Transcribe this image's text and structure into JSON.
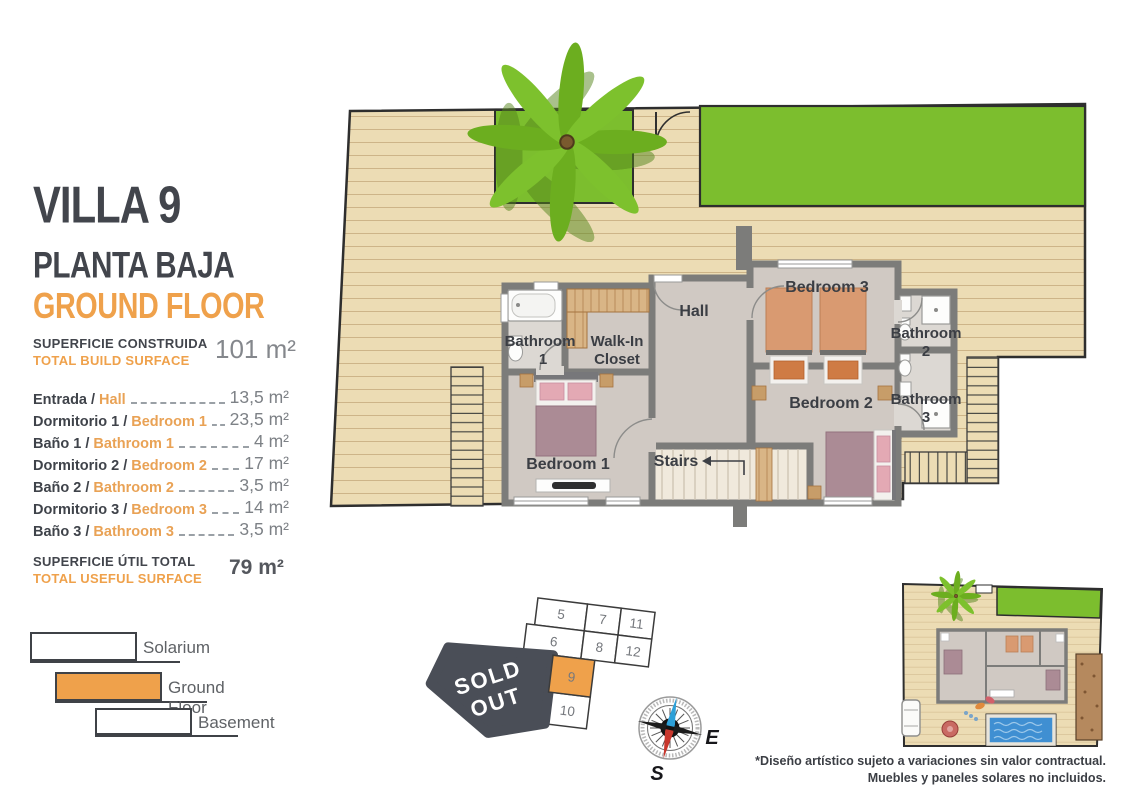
{
  "panel": {
    "title": "VILLA 9",
    "subtitle_es": "PLANTA BAJA",
    "subtitle_en": "GROUND FLOOR",
    "build": {
      "label_es": "SUPERFICIE CONSTRUIDA",
      "label_en": "TOTAL BUILD SURFACE",
      "value": "101 m²"
    },
    "rooms": [
      {
        "es": "Entrada /",
        "en": "Hall",
        "value": "13,5 m²"
      },
      {
        "es": "Dormitorio 1 /",
        "en": "Bedroom 1",
        "value": "23,5 m²"
      },
      {
        "es": "Baño 1 /",
        "en": "Bathroom 1",
        "value": "4 m²"
      },
      {
        "es": "Dormitorio 2 /",
        "en": "Bedroom 2",
        "value": "17 m²"
      },
      {
        "es": "Baño 2 /",
        "en": "Bathroom 2",
        "value": "3,5 m²"
      },
      {
        "es": "Dormitorio 3 /",
        "en": "Bedroom 3",
        "value": "14 m²"
      },
      {
        "es": "Baño 3 /",
        "en": "Bathroom 3",
        "value": "3,5 m²"
      }
    ],
    "useful": {
      "label_es": "SUPERFICIE ÚTIL TOTAL",
      "label_en": "TOTAL USEFUL SURFACE",
      "value": "79 m²"
    }
  },
  "legend": {
    "items": [
      {
        "label": "Solarium",
        "fill": "white"
      },
      {
        "label": "Ground Floor",
        "fill": "orange"
      },
      {
        "label": "Basement",
        "fill": "white"
      }
    ]
  },
  "floorplan": {
    "labels": {
      "bathroom1_l1": "Bathroom",
      "bathroom1_l2": "1",
      "wic_l1": "Walk-In",
      "wic_l2": "Closet",
      "hall": "Hall",
      "bedroom3": "Bedroom 3",
      "bathroom2_l1": "Bathroom",
      "bathroom2_l2": "2",
      "bedroom2": "Bedroom 2",
      "bathroom3_l1": "Bathroom",
      "bathroom3_l2": "3",
      "bedroom1": "Bedroom 1",
      "stairs": "Stairs"
    }
  },
  "plot_map": {
    "sold_line1": "SOLD",
    "sold_line2": "OUT",
    "cells": [
      {
        "label": "5"
      },
      {
        "label": "7"
      },
      {
        "label": "11"
      },
      {
        "label": "6"
      },
      {
        "label": "8"
      },
      {
        "label": "12"
      }
    ],
    "unit": {
      "label": "9",
      "highlighted": true
    },
    "below_unit": {
      "label": "10"
    }
  },
  "compass": {
    "east": "E",
    "south": "S"
  },
  "footnote": {
    "line1": "*Diseño artístico sujeto a variaciones sin valor contractual.",
    "line2": "Muebles y paneles solares no incluidos."
  },
  "icons": {
    "palm_tree": "palm-tree-icon",
    "compass": "compass-rose-icon",
    "pool": "pool-icon",
    "car": "car-icon"
  },
  "colors": {
    "accent": "#EFA14B",
    "dark": "#42454C",
    "lawn": "#7CBE2E",
    "deck": "#ECDCB4",
    "wall": "#7C7C7A",
    "sold": "#4A4E57",
    "pool": "#3F8FD2"
  }
}
